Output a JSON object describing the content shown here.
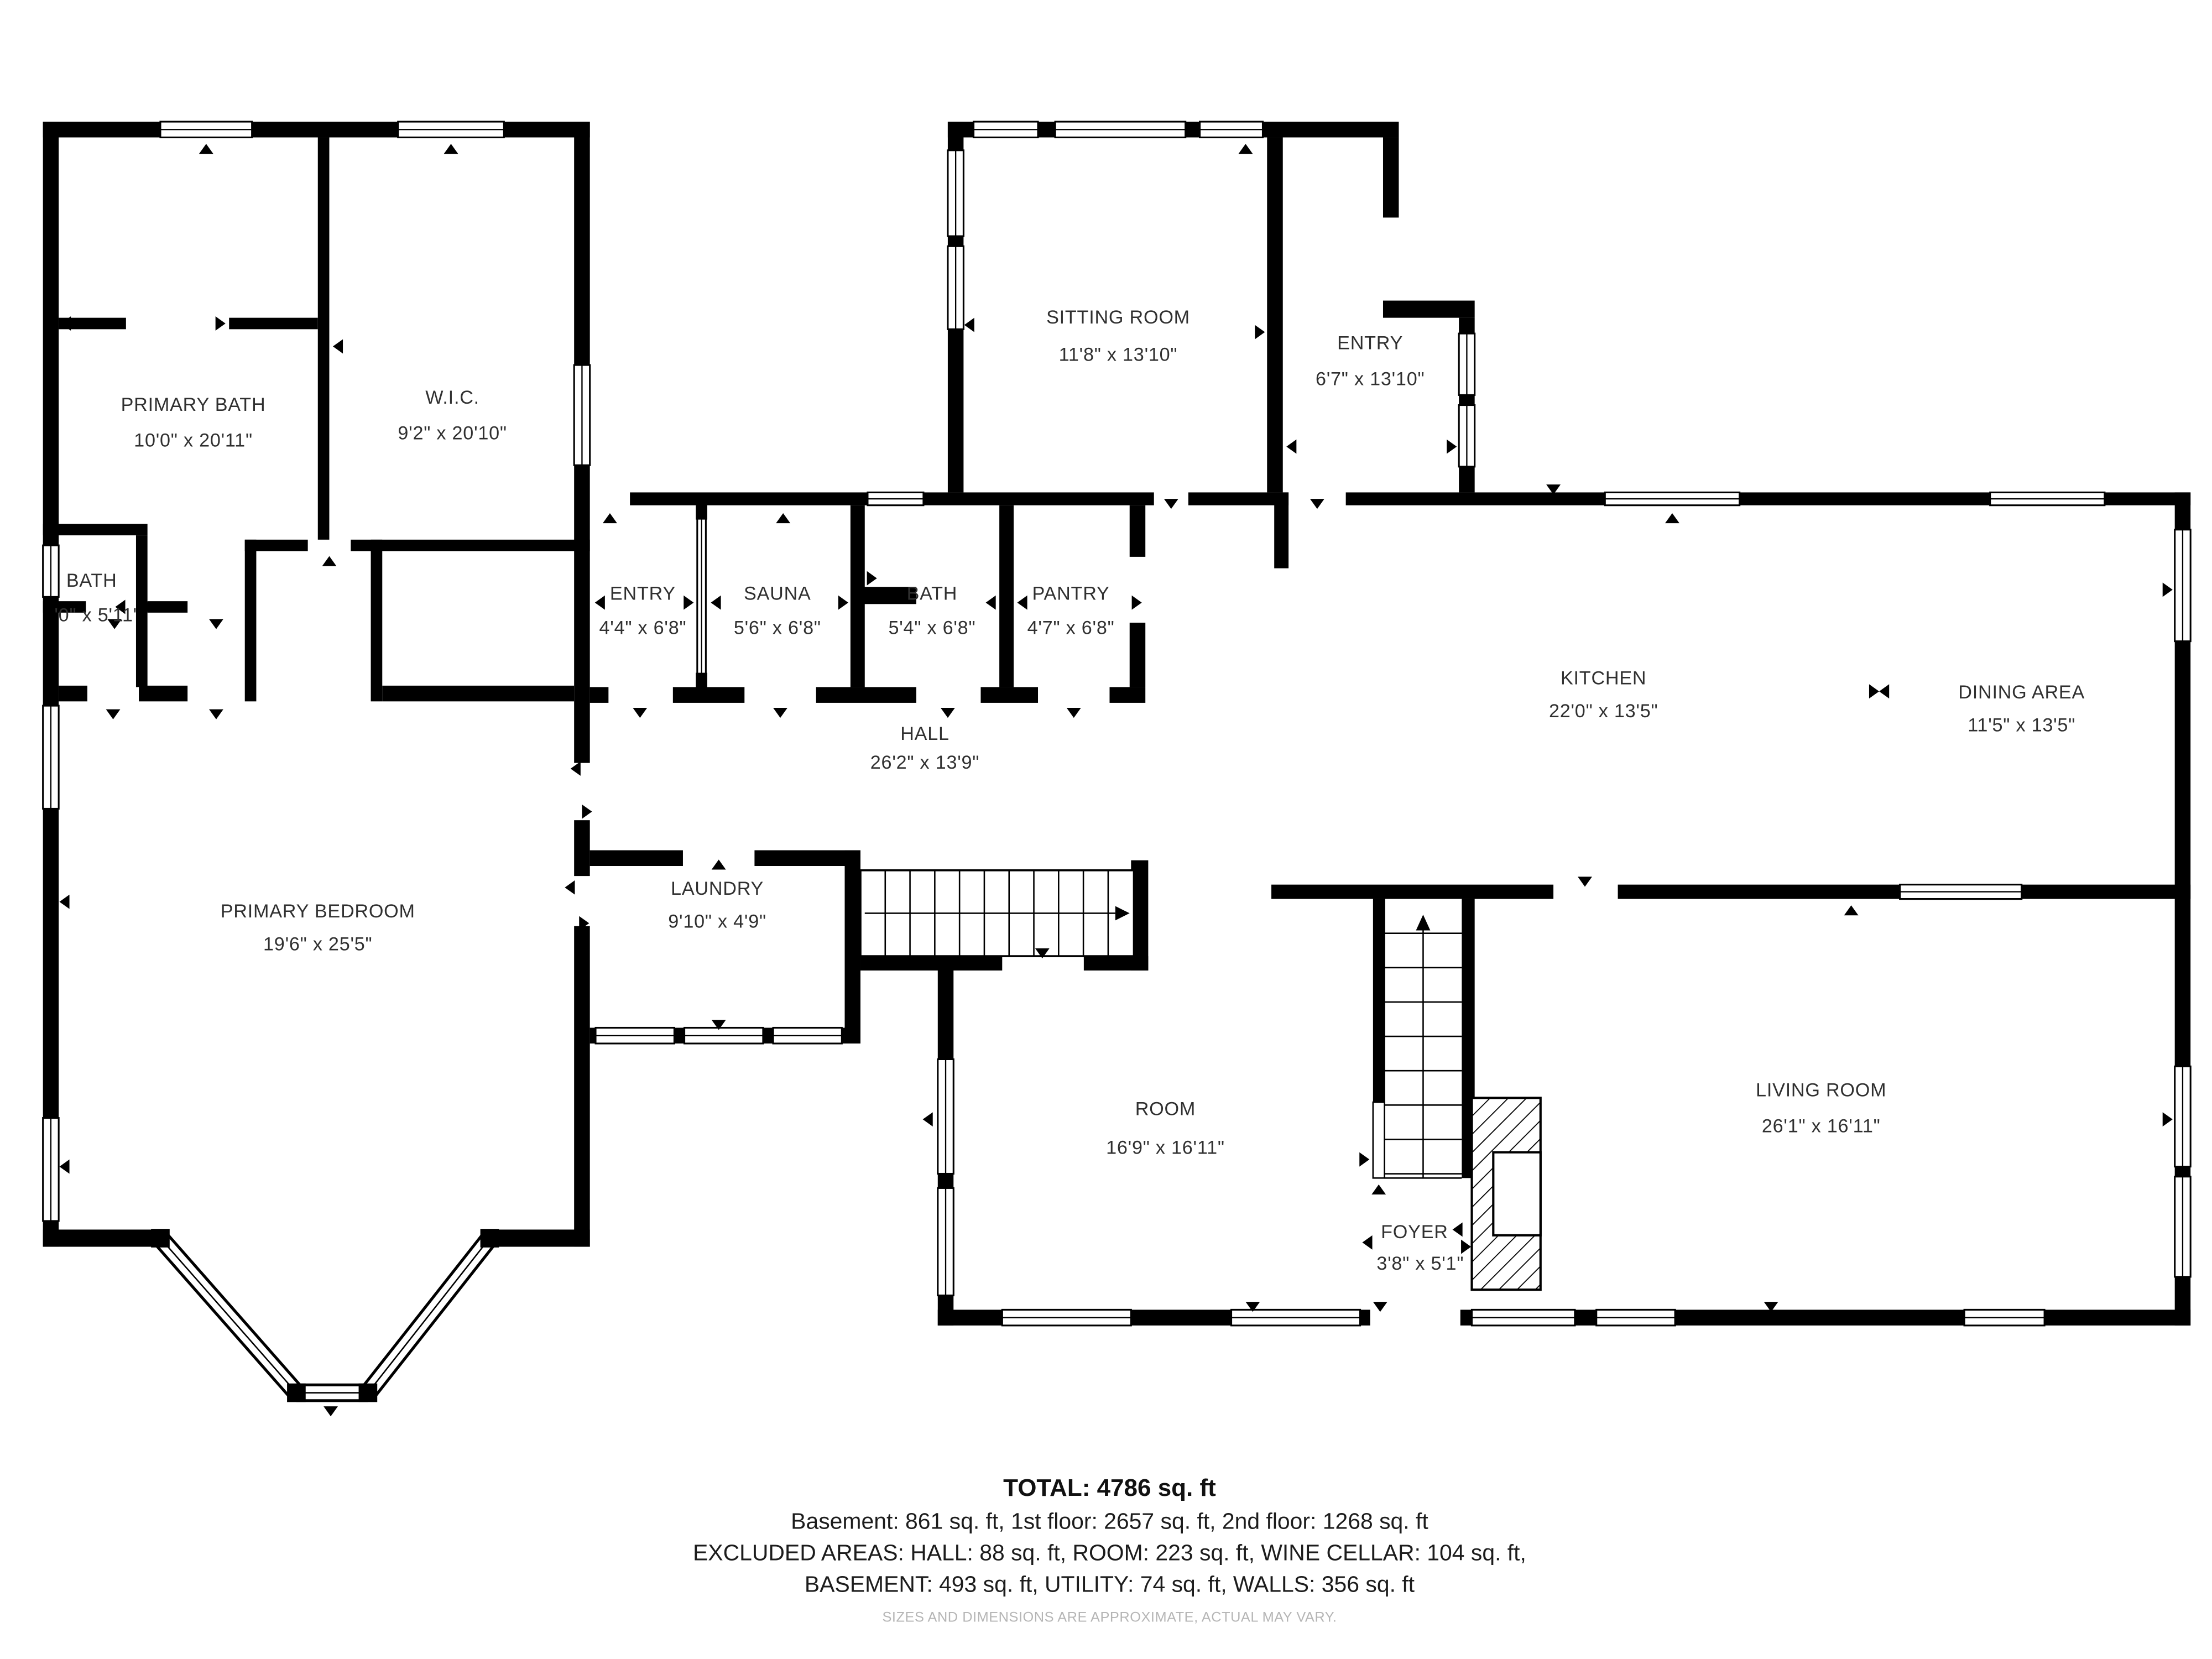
{
  "rooms": [
    {
      "name": "PRIMARY BATH",
      "dims": "10'0\" x 20'11\""
    },
    {
      "name": "W.I.C.",
      "dims": "9'2\" x 20'10\""
    },
    {
      "name": "BATH",
      "dims": "'0\" x 5'11\""
    },
    {
      "name": "SITTING ROOM",
      "dims": "11'8\" x 13'10\""
    },
    {
      "name": "ENTRY",
      "dims": "6'7\" x 13'10\""
    },
    {
      "name": "ENTRY",
      "dims": "4'4\" x 6'8\""
    },
    {
      "name": "SAUNA",
      "dims": "5'6\" x 6'8\""
    },
    {
      "name": "BATH",
      "dims": "5'4\" x 6'8\""
    },
    {
      "name": "PANTRY",
      "dims": "4'7\" x 6'8\""
    },
    {
      "name": "KITCHEN",
      "dims": "22'0\" x 13'5\""
    },
    {
      "name": "DINING AREA",
      "dims": "11'5\" x 13'5\""
    },
    {
      "name": "HALL",
      "dims": "26'2\" x 13'9\""
    },
    {
      "name": "PRIMARY BEDROOM",
      "dims": "19'6\" x 25'5\""
    },
    {
      "name": "LAUNDRY",
      "dims": "9'10\" x 4'9\""
    },
    {
      "name": "ROOM",
      "dims": "16'9\" x 16'11\""
    },
    {
      "name": "LIVING ROOM",
      "dims": "26'1\" x 16'11\""
    },
    {
      "name": "FOYER",
      "dims": "3'8\" x 5'1\""
    }
  ],
  "summary": {
    "total": "TOTAL: 4786 sq. ft",
    "line1": "Basement: 861 sq. ft, 1st floor: 2657 sq. ft, 2nd floor: 1268 sq. ft",
    "line2": "EXCLUDED AREAS: HALL: 88 sq. ft, ROOM: 223 sq. ft, WINE CELLAR: 104 sq. ft,",
    "line3": "BASEMENT: 493 sq. ft, UTILITY: 74 sq. ft, WALLS: 356 sq. ft"
  },
  "disclaimer": "SIZES AND DIMENSIONS ARE APPROXIMATE, ACTUAL MAY VARY.",
  "colors": {
    "wall": "#000000",
    "text": "#303030",
    "disclaimer": "#b5b5b5",
    "background": "#ffffff"
  }
}
